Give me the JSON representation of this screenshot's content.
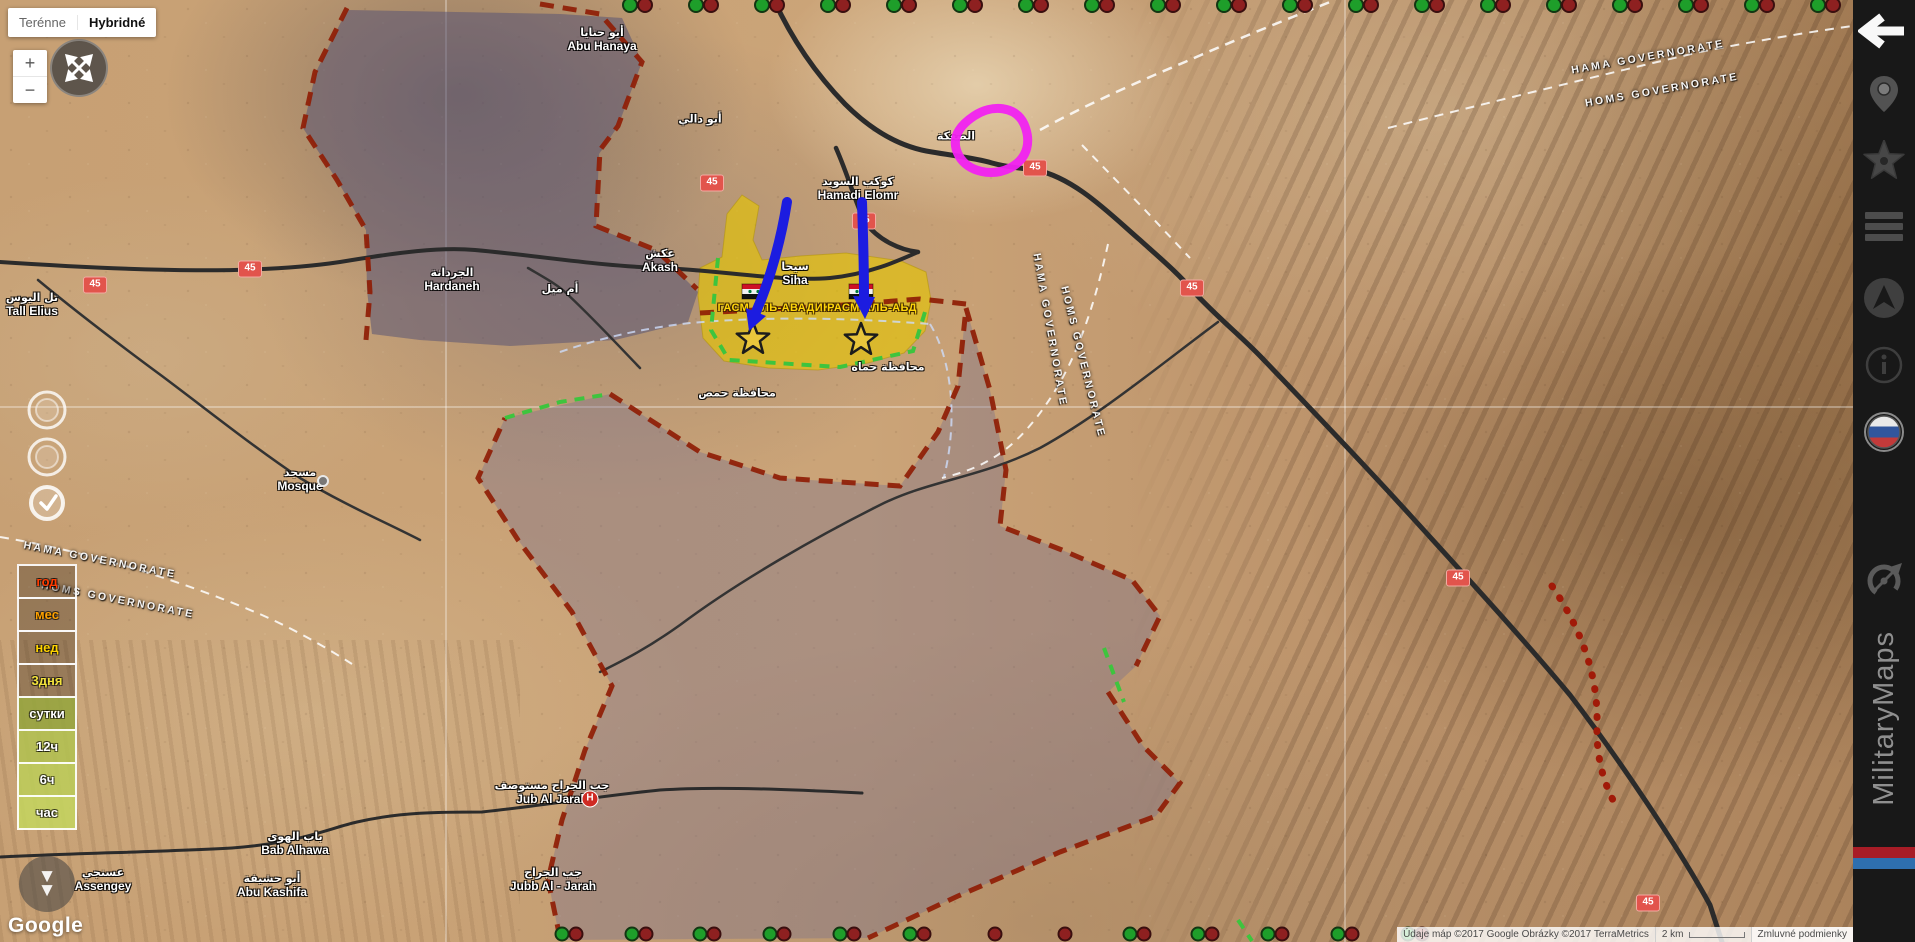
{
  "map_controls": {
    "terrain": "Terénne",
    "hybrid": "Hybridné",
    "zoom_in": "+",
    "zoom_out": "−",
    "arrow_down": "▼"
  },
  "legend": {
    "rows": [
      {
        "label": "год",
        "text_color": "#ff3b00",
        "bg": "rgba(35,25,18,0.30)"
      },
      {
        "label": "мес",
        "text_color": "#ffa200",
        "bg": "rgba(35,25,18,0.30)"
      },
      {
        "label": "нед",
        "text_color": "#ffd300",
        "bg": "rgba(35,25,18,0.30)"
      },
      {
        "label": "3дня",
        "text_color": "#f2e23c",
        "bg": "rgba(35,25,18,0.30)"
      },
      {
        "label": "сутки",
        "text_color": "#ffffff",
        "bg": "rgba(148,165,60,0.85)"
      },
      {
        "label": "12ч",
        "text_color": "#ffffff",
        "bg": "rgba(178,194,80,0.85)"
      },
      {
        "label": "6ч",
        "text_color": "#ffffff",
        "bg": "rgba(188,206,88,0.85)"
      },
      {
        "label": "час",
        "text_color": "#ffffff",
        "bg": "rgba(196,214,94,0.85)"
      }
    ]
  },
  "google_logo": "Google",
  "attribution": {
    "data_credit": "Údaje máp ©2017 Google Obrázky ©2017 TerraMetrics",
    "scale": "2 km",
    "terms": "Zmluvné podmienky"
  },
  "sidebar": {
    "brand": "MilitaryMaps",
    "icon_names": [
      "back-arrow-icon",
      "location-pin-icon",
      "star-icon",
      "list-icon",
      "navigation-icon",
      "info-icon",
      "russian-flag-icon",
      "compass-icon"
    ]
  },
  "colors": {
    "magenta_annotation": "#f122f1",
    "blue_arrow": "#1c1ce0",
    "yellow_zone": "#e6c600",
    "purple_zone": "#6c6894",
    "red_border": "#8f1d05",
    "green_border": "#3ec43e",
    "route_shield": "#e2544c",
    "dot_green": "#1e9e2a",
    "dot_red": "#8e2020",
    "stripe_red": "#a81c26",
    "stripe_blue": "#2e6fae"
  },
  "map": {
    "route_shield_label": "45",
    "route_shields": [
      {
        "x": 95,
        "y": 285
      },
      {
        "x": 250,
        "y": 269
      },
      {
        "x": 712,
        "y": 183
      },
      {
        "x": 864,
        "y": 221
      },
      {
        "x": 1035,
        "y": 168
      },
      {
        "x": 1192,
        "y": 288
      },
      {
        "x": 1458,
        "y": 578
      },
      {
        "x": 1648,
        "y": 903
      }
    ],
    "place_labels": [
      {
        "en": "Abu Hanaya",
        "ar": "أبو حنايا",
        "x": 602,
        "y": 40
      },
      {
        "en": "Tall Elius",
        "ar": "تل اليوس",
        "x": 32,
        "y": 305
      },
      {
        "en": "Hardaneh",
        "ar": "الجردانة",
        "x": 452,
        "y": 280
      },
      {
        "en": "Akash",
        "ar": "عكش",
        "x": 660,
        "y": 261
      },
      {
        "en": "",
        "ar": "أم ميل",
        "x": 560,
        "y": 290
      },
      {
        "en": "Siha",
        "ar": "سيحا",
        "x": 795,
        "y": 274
      },
      {
        "en": "Hamadi Elomr",
        "ar": "كوكب السويد",
        "x": 858,
        "y": 189
      },
      {
        "en": "",
        "ar": "الصعكة",
        "x": 956,
        "y": 137
      },
      {
        "en": "",
        "ar": "أبو دالي",
        "x": 700,
        "y": 120
      },
      {
        "en": "Mosque",
        "ar": "مسجد",
        "x": 300,
        "y": 480
      },
      {
        "en": "Jub Al Jarah",
        "ar": "جب الجراح مستوصف",
        "x": 552,
        "y": 793
      },
      {
        "en": "Jubb Al - Jarah",
        "ar": "جب الجراح",
        "x": 553,
        "y": 880
      },
      {
        "en": "Bab Alhawa",
        "ar": "باب الهوى",
        "x": 295,
        "y": 844
      },
      {
        "en": "Abu Kashifa",
        "ar": "أبو حشيفة",
        "x": 272,
        "y": 886
      },
      {
        "en": "Assengey",
        "ar": "عسنجي",
        "x": 103,
        "y": 880
      },
      {
        "en": "",
        "ar": "محافظة حماه",
        "x": 888,
        "y": 368
      },
      {
        "en": "",
        "ar": "محافظة حمص",
        "x": 737,
        "y": 394
      }
    ],
    "governorate_labels": [
      {
        "text": "HAMA GOVERNORATE",
        "x": 100,
        "y": 560,
        "rot": 11
      },
      {
        "text": "HOMS GOVERNORATE",
        "x": 118,
        "y": 600,
        "rot": 11
      },
      {
        "text": "HAMA GOVERNORATE",
        "x": 1050,
        "y": 330,
        "rot": 80
      },
      {
        "text": "HOMS GOVERNORATE",
        "x": 1083,
        "y": 362,
        "rot": 76
      },
      {
        "text": "HAMA GOVERNORATE",
        "x": 1648,
        "y": 57,
        "rot": -10
      },
      {
        "text": "HOMS GOVERNORATE",
        "x": 1662,
        "y": 90,
        "rot": -10
      }
    ],
    "zone_labels": [
      {
        "text": "ГАСМ АЛЬ-АВАДИКА",
        "x": 778,
        "y": 308
      },
      {
        "text": "РАСМ АЛЬ-АЬД",
        "x": 872,
        "y": 308
      }
    ],
    "markers": {
      "hospital": {
        "label": "H",
        "x": 590,
        "y": 799
      },
      "mosque": {
        "x": 323,
        "y": 481
      }
    },
    "unit_dots": {
      "top": {
        "start": 630,
        "step": 66,
        "count": 19,
        "y": 5,
        "r": 7
      },
      "bottom": {
        "y": 934,
        "r": 6.5,
        "items": [
          {
            "x": 562,
            "t": "pair"
          },
          {
            "x": 632,
            "t": "pair"
          },
          {
            "x": 700,
            "t": "pair"
          },
          {
            "x": 770,
            "t": "pair"
          },
          {
            "x": 840,
            "t": "pair"
          },
          {
            "x": 910,
            "t": "pair"
          },
          {
            "x": 995,
            "t": "red"
          },
          {
            "x": 1065,
            "t": "red"
          },
          {
            "x": 1130,
            "t": "pair"
          },
          {
            "x": 1198,
            "t": "pair"
          },
          {
            "x": 1268,
            "t": "pair"
          },
          {
            "x": 1338,
            "t": "pair"
          },
          {
            "x": 1408,
            "t": "pair"
          }
        ]
      }
    }
  }
}
